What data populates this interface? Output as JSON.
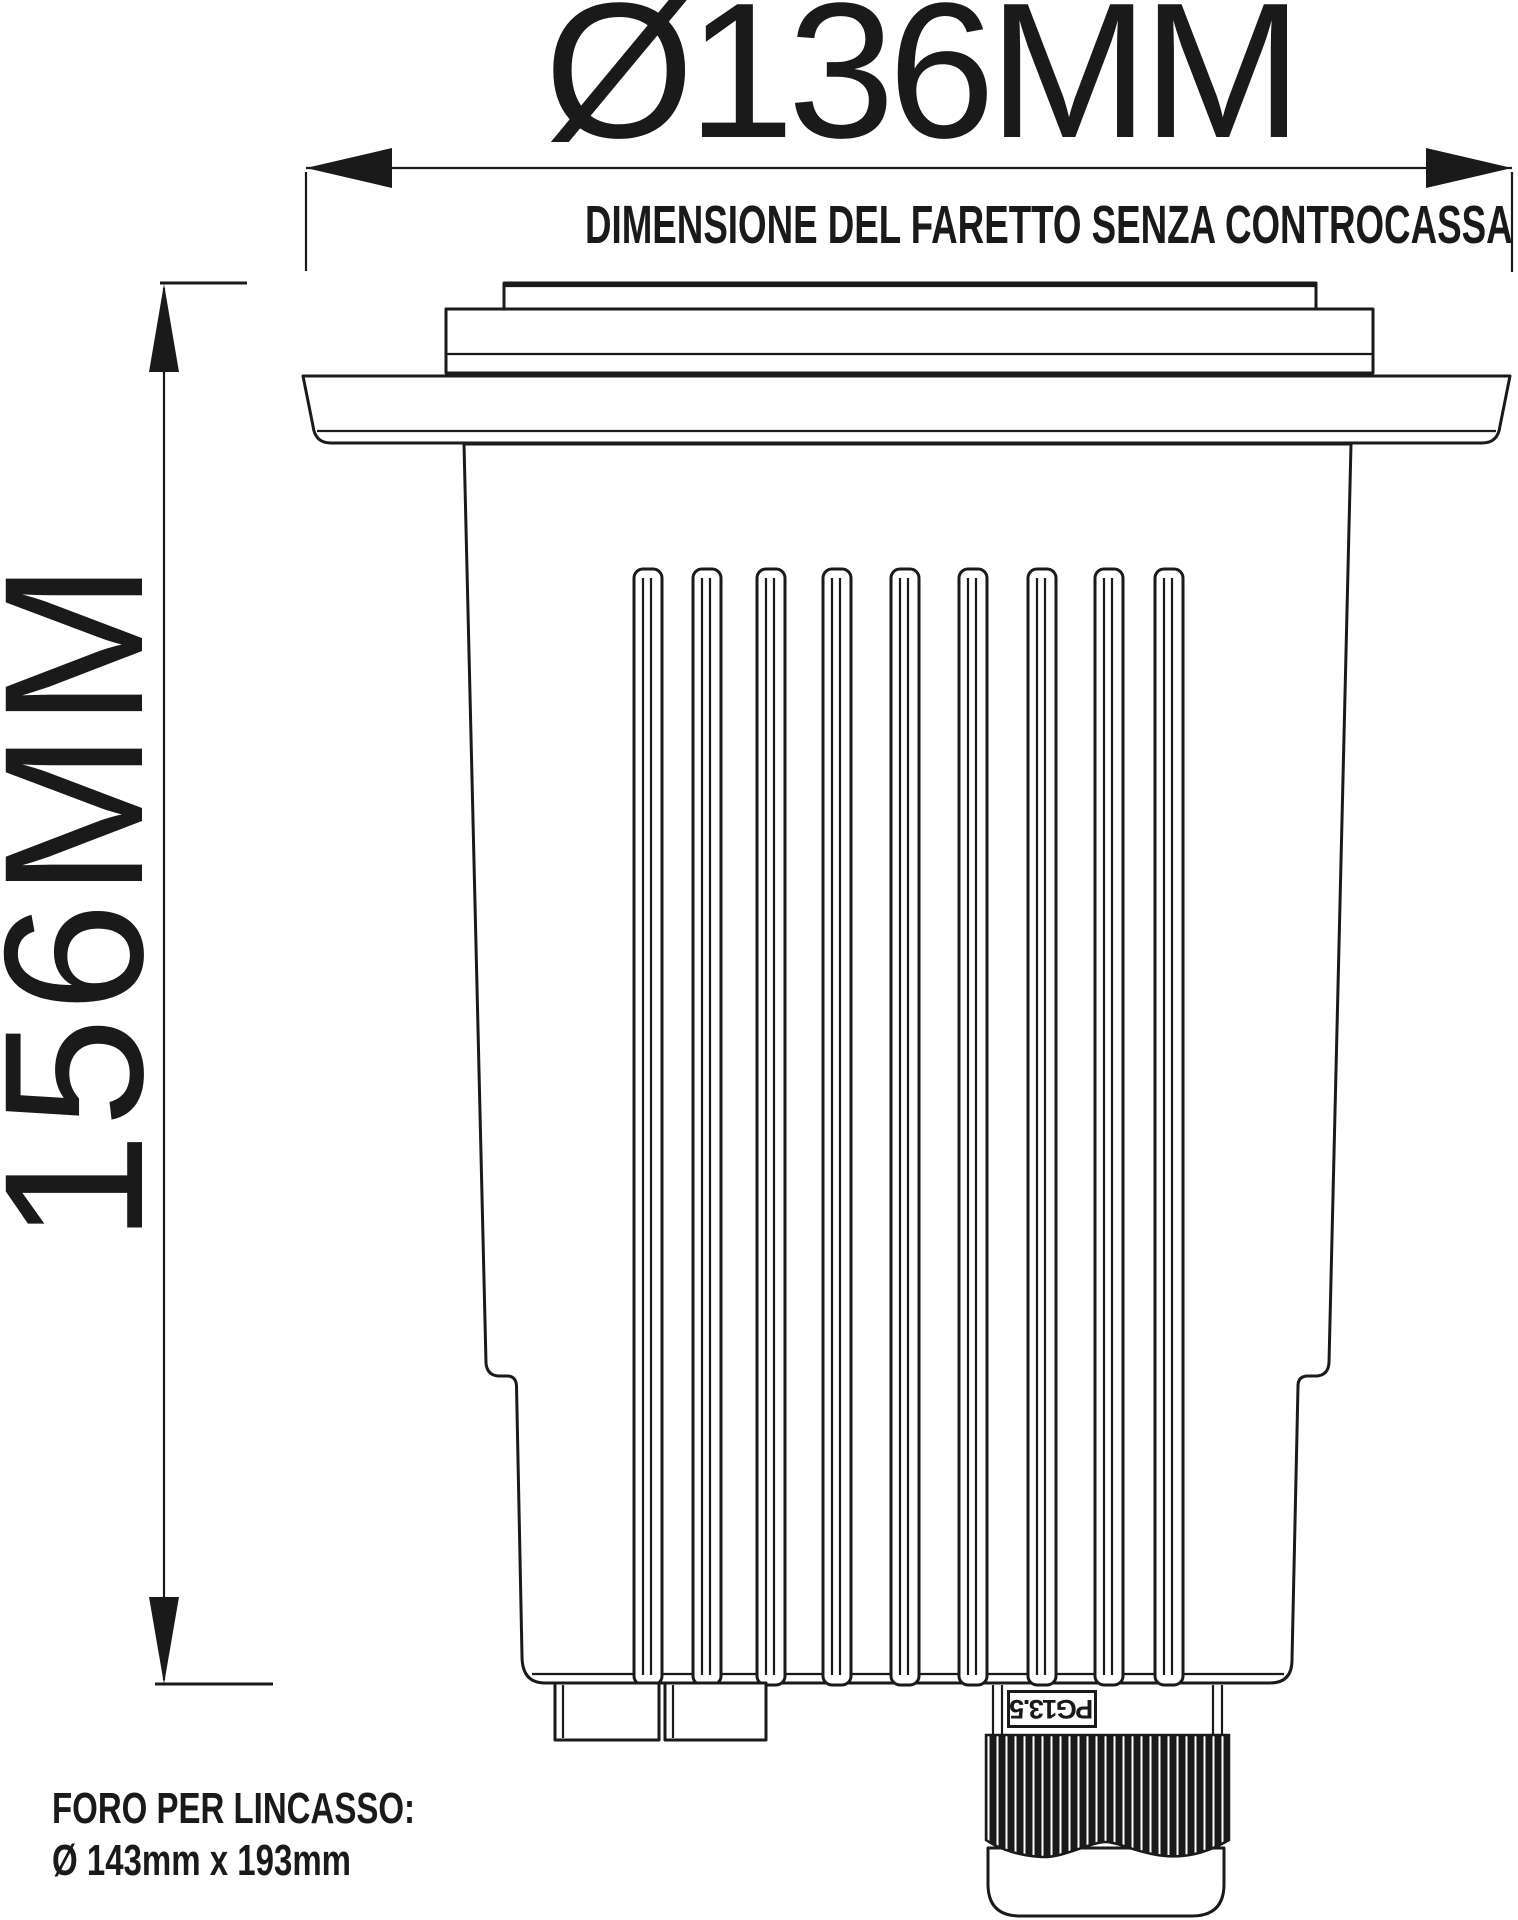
{
  "drawing": {
    "diameter_label": "Ø136MM",
    "diameter_note": "DIMENSIONE DEL FARETTO SENZA CONTROCASSA",
    "height_label": "156MM",
    "cutout": {
      "title": "FORO PER LINCASSO:",
      "size": "Ø 143mm x 193mm"
    },
    "cable_gland_label": "PG13.5"
  },
  "colors": {
    "ink": "#1a1a1a",
    "paper": "#ffffff"
  },
  "icons": {
    "dimension_arrows": "solid triangular dimension arrowheads"
  }
}
